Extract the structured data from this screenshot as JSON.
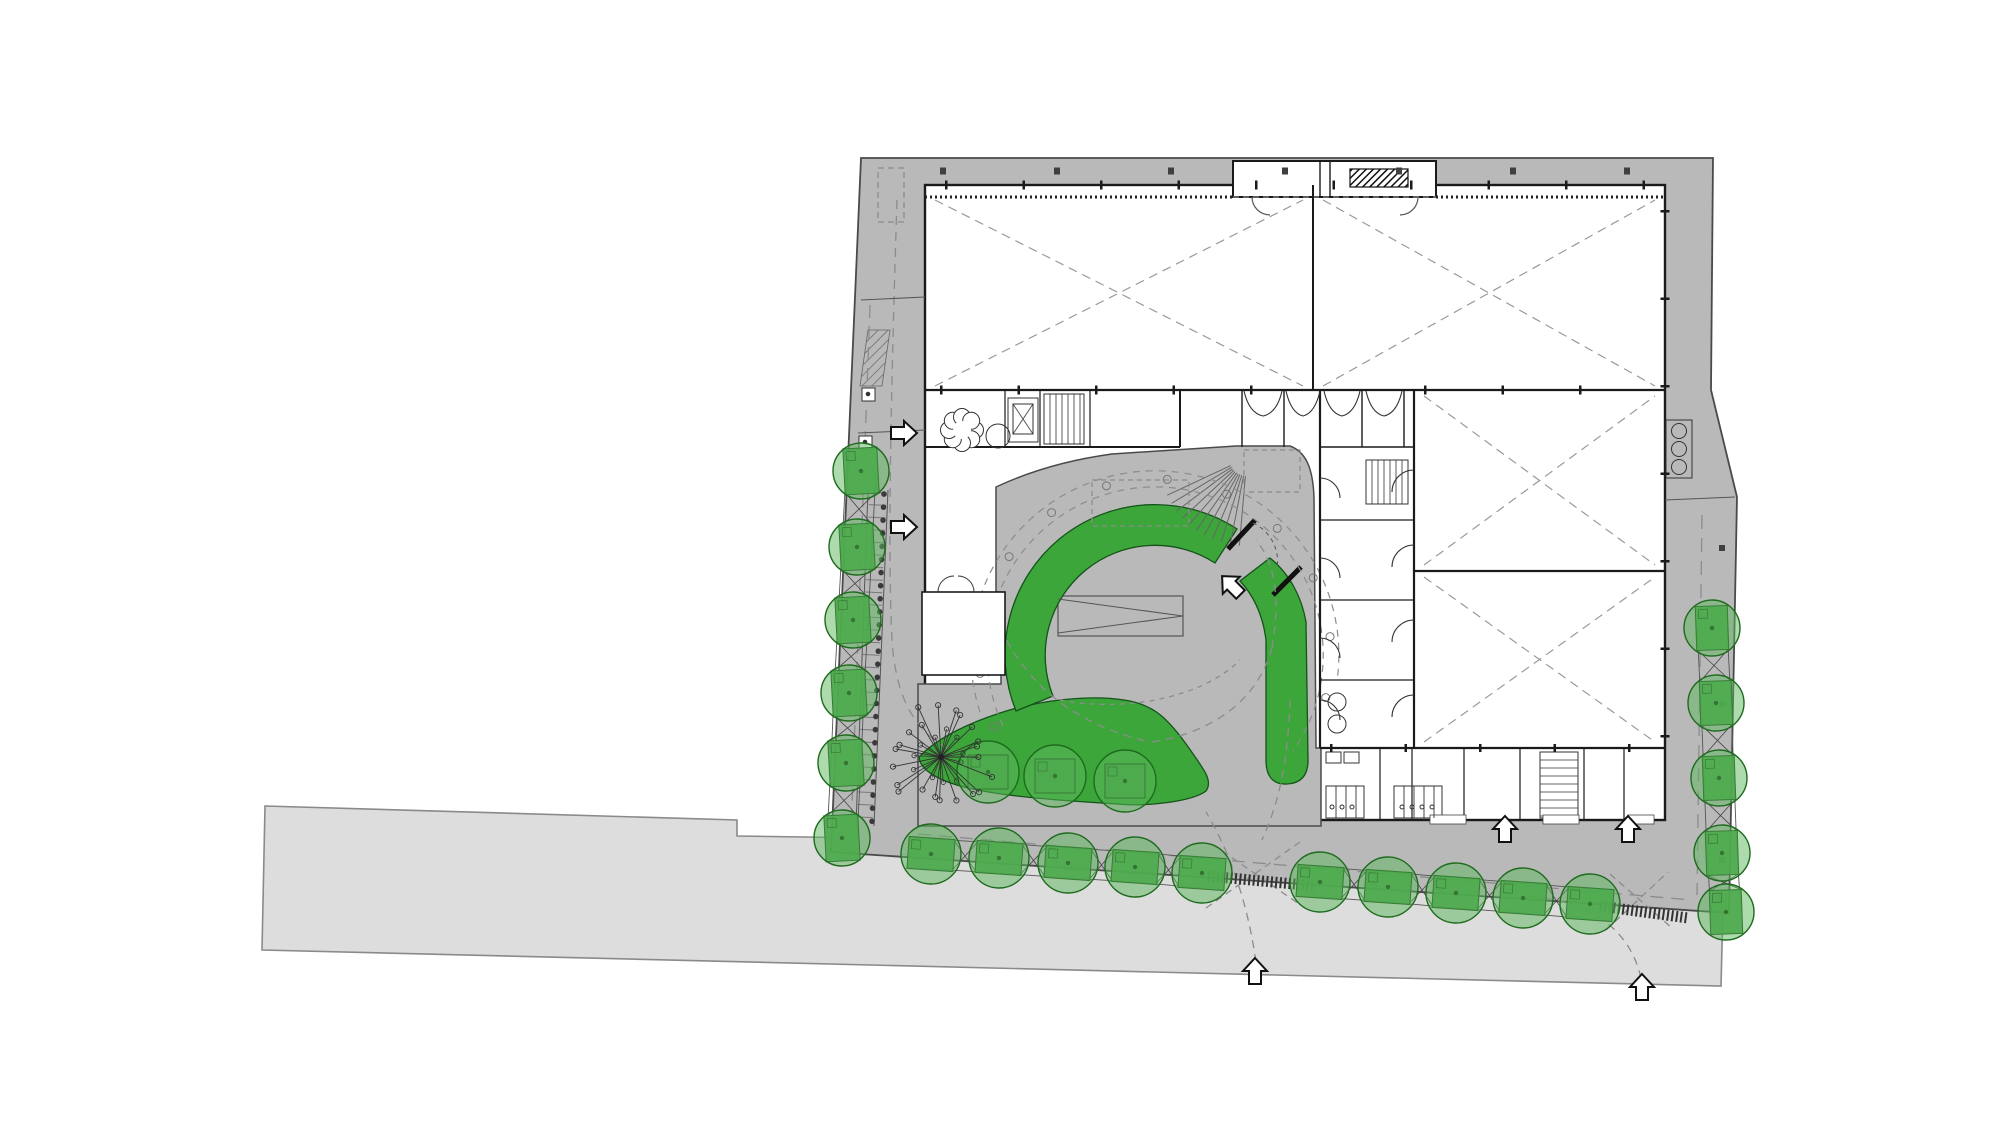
{
  "drawing": {
    "kind": "architectural-site-plan",
    "canvas": {
      "w": 2000,
      "h": 1143
    },
    "palette": {
      "paper": "#ffffff",
      "street_fill": "#dddddd",
      "street_stroke": "#8a8a8a",
      "sidewalk_fill": "#b9b9b9",
      "sidewalk_stroke": "#4a4a4a",
      "building_fill": "#ffffff",
      "wall": "#1a1a1a",
      "detail": "#555555",
      "dash": "#8c8c8c",
      "green_main": "#3ca63a",
      "green_main_stroke": "#15531a",
      "tree_fill": "#5cb85c",
      "tree_stroke": "#1d6b1d",
      "planter_fill": "#3f9d3f",
      "planter_stroke": "#163f16",
      "branch": "#333333"
    },
    "street": {
      "points": [
        [
          265,
          806
        ],
        [
          737,
          820
        ],
        [
          737,
          836
        ],
        [
          1694,
          850
        ],
        [
          1725,
          830
        ],
        [
          1721,
          986
        ],
        [
          262,
          950
        ]
      ]
    },
    "site": {
      "points": [
        [
          861,
          158
        ],
        [
          1713,
          158
        ],
        [
          1711,
          390
        ],
        [
          1737,
          497
        ],
        [
          1729,
          913
        ],
        [
          831,
          852
        ]
      ]
    },
    "building": {
      "x": 925,
      "y": 185,
      "w": 740,
      "h": 635
    },
    "plaza_path": "M918,826 L918,684 L1001,684 L1001,592 L996,592 L996,487 C1028,472 1068,460 1112,454 L1236,446 L1290,446 C1306,452 1313,468 1314,498 L1316,748 L1321,748 L1321,826 Z",
    "niche": {
      "rect": [
        1233,
        161,
        203,
        36
      ],
      "hatch_bar": [
        1350,
        169,
        58,
        18
      ],
      "walls": [
        [
          1320,
          162,
          1320,
          196
        ],
        [
          1330,
          162,
          1330,
          196
        ]
      ],
      "arcs": [
        "M1252,197 A18,18 0 0 0 1270,215",
        "M1418,197 A18,18 0 0 1 1400,215"
      ]
    },
    "room_block": {
      "rect": [
        922,
        592,
        83,
        83
      ],
      "arcs": [
        "M938,592 A16,16 0 0 1 954,576",
        "M974,592 A16,16 0 0 0 958,576"
      ]
    },
    "halls_x": [
      [
        935,
        200,
        1303,
        386
      ],
      [
        1323,
        200,
        1655,
        386
      ],
      [
        1424,
        396,
        1655,
        565
      ],
      [
        1424,
        577,
        1655,
        742
      ]
    ],
    "walls": [
      [
        925,
        390,
        1665,
        390,
        2.2
      ],
      [
        1313,
        185,
        1313,
        390,
        2.0
      ],
      [
        925,
        447,
        1180,
        447,
        2.0
      ],
      [
        1180,
        390,
        1180,
        447,
        2.0
      ],
      [
        1320,
        390,
        1320,
        748,
        2.2
      ],
      [
        1414,
        390,
        1414,
        748,
        2.2
      ],
      [
        1414,
        571,
        1665,
        571,
        2.2
      ],
      [
        1320,
        748,
        1665,
        748,
        2.2
      ],
      [
        1320,
        447,
        1414,
        447,
        1.5
      ],
      [
        1242,
        390,
        1242,
        447,
        1.4
      ],
      [
        1284,
        390,
        1284,
        447,
        1.4
      ],
      [
        1362,
        390,
        1362,
        447,
        1.4
      ],
      [
        1404,
        390,
        1404,
        447,
        1.4
      ],
      [
        1380,
        748,
        1380,
        820,
        1.2
      ],
      [
        1412,
        748,
        1412,
        820,
        1.2
      ],
      [
        1464,
        748,
        1464,
        820,
        1.2
      ],
      [
        1520,
        748,
        1520,
        820,
        1.2
      ],
      [
        1584,
        748,
        1584,
        820,
        1.2
      ],
      [
        1624,
        748,
        1624,
        820,
        1.2
      ],
      [
        1320,
        520,
        1414,
        520,
        1.2
      ],
      [
        1320,
        600,
        1414,
        600,
        1.2
      ],
      [
        1320,
        680,
        1414,
        680,
        1.2
      ],
      [
        1005,
        390,
        1005,
        447,
        1.2
      ],
      [
        1040,
        390,
        1040,
        447,
        1.2
      ],
      [
        1090,
        390,
        1090,
        447,
        1.2
      ],
      [
        963,
        592,
        963,
        675,
        1.1
      ]
    ],
    "thin_lines": [
      [
        888,
        490,
        874,
        826
      ],
      [
        868,
        490,
        856,
        826
      ],
      [
        861,
        300,
        925,
        297
      ],
      [
        858,
        433,
        925,
        430
      ],
      [
        1665,
        500,
        1735,
        497
      ],
      [
        1013,
        404,
        1033,
        434
      ],
      [
        1013,
        434,
        1033,
        404
      ],
      [
        1058,
        599,
        1183,
        616
      ],
      [
        1058,
        633,
        1183,
        616
      ]
    ],
    "bench": {
      "rect": [
        1058,
        596,
        125,
        40
      ]
    },
    "stairs": [
      {
        "x": 1044,
        "y": 394,
        "w": 40,
        "h": 50,
        "dir": "v",
        "step": 6
      },
      {
        "x": 1366,
        "y": 460,
        "w": 42,
        "h": 44,
        "dir": "v",
        "step": 6
      },
      {
        "x": 1540,
        "y": 752,
        "w": 38,
        "h": 66,
        "dir": "h",
        "step": 8
      }
    ],
    "fan_stair": {
      "cx": 1247,
      "cy": 458,
      "a1": 95,
      "a2": 155,
      "r1": 18,
      "r2": 88,
      "n": 11
    },
    "flower": {
      "cx": 962,
      "cy": 430,
      "petal_r": 8.5,
      "ring_r": 13,
      "petals": 8,
      "side_circle": [
        998,
        436,
        12
      ]
    },
    "rects": [
      {
        "x": 1008,
        "y": 398,
        "w": 30,
        "h": 44,
        "f": "none"
      },
      {
        "x": 1013,
        "y": 404,
        "w": 20,
        "h": 30,
        "f": "none"
      },
      {
        "x": 1666,
        "y": 420,
        "w": 26,
        "h": 58,
        "f": "none"
      },
      {
        "x": 862,
        "y": 388,
        "w": 13,
        "h": 13,
        "f": "#fff"
      },
      {
        "x": 859,
        "y": 436,
        "w": 13,
        "h": 13,
        "f": "#fff"
      },
      {
        "x": 1326,
        "y": 752,
        "w": 15,
        "h": 11,
        "f": "none"
      },
      {
        "x": 1344,
        "y": 752,
        "w": 15,
        "h": 11,
        "f": "none"
      },
      {
        "x": 1326,
        "y": 786,
        "w": 38,
        "h": 32,
        "f": "none"
      },
      {
        "x": 1394,
        "y": 786,
        "w": 48,
        "h": 32,
        "f": "none"
      }
    ],
    "white_openings": [
      [
        1430,
        815,
        36,
        9
      ],
      [
        1543,
        815,
        36,
        9
      ],
      [
        1628,
        815,
        26,
        9
      ]
    ],
    "stall_lines": [
      [
        1336,
        786,
        1336,
        818
      ],
      [
        1346,
        786,
        1346,
        818
      ],
      [
        1356,
        786,
        1356,
        818
      ],
      [
        1404,
        786,
        1404,
        818
      ],
      [
        1414,
        786,
        1414,
        818
      ],
      [
        1424,
        786,
        1424,
        818
      ],
      [
        1434,
        786,
        1434,
        818
      ]
    ],
    "circles": [
      {
        "cx": 1679,
        "cy": 431,
        "r": 7.5
      },
      {
        "cx": 1679,
        "cy": 449,
        "r": 7.5
      },
      {
        "cx": 1679,
        "cy": 467,
        "r": 7.5
      },
      {
        "cx": 1337,
        "cy": 702,
        "r": 9
      },
      {
        "cx": 1337,
        "cy": 724,
        "r": 9
      },
      {
        "cx": 868,
        "cy": 394,
        "r": 1.8,
        "fill": "#333"
      },
      {
        "cx": 865,
        "cy": 442,
        "r": 1.8,
        "fill": "#333"
      },
      {
        "cx": 1332,
        "cy": 807,
        "r": 2
      },
      {
        "cx": 1342,
        "cy": 807,
        "r": 2
      },
      {
        "cx": 1352,
        "cy": 807,
        "r": 2
      },
      {
        "cx": 1402,
        "cy": 807,
        "r": 2
      },
      {
        "cx": 1412,
        "cy": 807,
        "r": 2
      },
      {
        "cx": 1422,
        "cy": 807,
        "r": 2
      },
      {
        "cx": 1432,
        "cy": 807,
        "r": 2
      }
    ],
    "doors": [
      "M1320,478 A20,20 0 0 1 1340,498",
      "M1320,558 A20,20 0 0 1 1340,578",
      "M1320,638 A20,20 0 0 1 1340,658",
      "M1320,700 A20,20 0 0 1 1340,720",
      "M1414,470 A22,22 0 0 0 1392,492",
      "M1414,545 A22,22 0 0 0 1392,567",
      "M1414,620 A22,22 0 0 0 1392,642",
      "M1414,695 A22,22 0 0 0 1392,717",
      "M1244,391 Q1249,413 1263,416 Q1277,413 1282,391",
      "M1286,391 Q1291,413 1303,416 Q1315,413 1320,391",
      "M1324,391 Q1329,413 1342,416 Q1355,413 1360,391",
      "M1366,391 Q1371,413 1384,416 Q1397,413 1402,391"
    ],
    "crescent": {
      "a": "M1016,711 A150,150 0 0 1 1237,529 L1215,563 A110,110 0 0 0 1053,696 Z",
      "b": "M1270,558 C1290,574 1302,598 1306,622 L1308,758 Q1309,783 1287,784 Q1266,785 1266,760 L1266,640 C1263,616 1254,596 1240,581 Z"
    },
    "amoeba_path": "M919,757 C938,737 972,722 1000,713 C1042,699 1093,695 1124,700 C1152,704 1167,716 1191,751 C1205,771 1213,781 1206,791 C1193,801 1149,807 1117,804 C1068,801 1008,797 973,789 C944,783 920,772 919,757 Z",
    "rings": {
      "cx": 1155,
      "cy": 655,
      "r1": 168,
      "r2": 184,
      "dot_r": 176,
      "dot_angles": [
        204,
        186,
        166,
        146,
        126,
        106,
        86,
        66,
        46,
        26,
        6,
        -14
      ],
      "arc1": "M1003,726 A168,168 0 1 1 1293,751",
      "arc2": "M980,712 A184,184 0 1 1 1337,681"
    },
    "gates": {
      "bars": [
        [
          1228,
          549,
          1255,
          520
        ],
        [
          1273,
          595,
          1301,
          567
        ]
      ],
      "swing": "M1253,523 A42,42 0 0 1 1277,568"
    },
    "dash_paths": [
      {
        "d": "M918,834 L1692,900",
        "dash": "13 8"
      },
      {
        "d": "M870,305 L851,832",
        "dash": "13 8"
      },
      {
        "d": "M897,200 C890,420 888,560 892,640 C896,700 915,733 955,752",
        "dash": "9 7"
      },
      {
        "d": "M1256,962 C1248,906 1232,856 1206,812",
        "dash": "8 6"
      },
      {
        "d": "M1641,978 C1630,930 1592,902 1530,896",
        "dash": "8 6"
      },
      {
        "d": "M1206,908 L1300,842",
        "dash": "7 5"
      },
      {
        "d": "M1212,844 L1302,906",
        "dash": "7 5"
      },
      {
        "d": "M1606,930 L1668,872",
        "dash": "7 5"
      },
      {
        "d": "M1610,874 L1672,928",
        "dash": "7 5"
      },
      {
        "d": "M1000,628 C1030,690 1080,726 1150,742",
        "dash": "8 6"
      },
      {
        "d": "M1152,742 C1216,732 1258,698 1272,648",
        "dash": "8 6"
      },
      {
        "d": "M1272,648 C1280,600 1276,564 1256,540",
        "dash": "8 6"
      },
      {
        "d": "M1060,700 C1120,712 1200,700 1240,660",
        "dash": "5 5"
      },
      {
        "d": "M1290,700 C1288,760 1280,800 1262,840",
        "dash": "8 6"
      },
      {
        "d": "M1092,480 H1189 V526 H1092 Z",
        "dash": "5 4"
      },
      {
        "d": "M878,168 H904 V222 H878 Z",
        "dash": "6 4"
      },
      {
        "d": "M1244,450 H1300 V492 H1244 Z",
        "dash": "5 4"
      },
      {
        "d": "M1702,515 L1697,895",
        "dash": "14 9"
      },
      {
        "d": "M1233,197 H1436",
        "dash": "6 4"
      }
    ],
    "tick_lines": [
      [
        940,
        171,
        1660,
        171,
        "6 108",
        7,
        "#3f3f3f",
        ""
      ],
      [
        945,
        185,
        1655,
        185,
        "2.5 75",
        9,
        "#1a1a1a",
        ""
      ],
      [
        940,
        390,
        1310,
        390,
        "2.5 75",
        9,
        "#1a1a1a",
        ""
      ],
      [
        1424,
        390,
        1655,
        390,
        "2.5 75",
        9,
        "#1a1a1a",
        ""
      ],
      [
        1330,
        748,
        1655,
        748,
        "2.5 72",
        8,
        "#1a1a1a",
        ""
      ],
      [
        1665,
        210,
        1665,
        812,
        "2.5 85",
        9,
        "#1a1a1a",
        ""
      ],
      [
        925,
        197,
        1233,
        197,
        "2 3",
        3,
        "#222222",
        ""
      ],
      [
        1436,
        197,
        1665,
        197,
        "2 3",
        3,
        "#222222",
        ""
      ],
      [
        1722,
        545,
        1722,
        885,
        "6 150",
        6,
        "#3f3f3f",
        ""
      ],
      [
        878,
        492,
        864,
        824,
        "1 11.5",
        17,
        "#777777",
        ""
      ],
      [
        884,
        494,
        872,
        822,
        "0.1 13",
        5.5,
        "#3a3a3a",
        "round"
      ],
      [
        1208,
        876,
        1316,
        886,
        "2 2.5",
        11,
        "#333333",
        ""
      ],
      [
        1600,
        906,
        1688,
        918,
        "2 2.5",
        11,
        "#333333",
        ""
      ]
    ],
    "tree_rows": [
      {
        "name": "left-sidewalk-trees",
        "r": 28,
        "planter": [
          34,
          46
        ],
        "rot": -3,
        "trench": true,
        "pts": [
          [
            861,
            471
          ],
          [
            857,
            547
          ],
          [
            853,
            620
          ],
          [
            849,
            693
          ],
          [
            846,
            763
          ],
          [
            842,
            838
          ]
        ]
      },
      {
        "name": "bottom-sidewalk-trees",
        "r": 30,
        "planter": [
          46,
          32
        ],
        "rot": 4,
        "trench": true,
        "pts": [
          [
            931,
            854
          ],
          [
            999,
            858
          ],
          [
            1068,
            863
          ],
          [
            1135,
            867
          ],
          [
            1202,
            873
          ],
          [
            1320,
            882
          ],
          [
            1388,
            887
          ],
          [
            1456,
            893
          ],
          [
            1523,
            898
          ],
          [
            1590,
            904
          ]
        ]
      },
      {
        "name": "right-sidewalk-trees",
        "r": 28,
        "planter": [
          32,
          44
        ],
        "rot": -2,
        "trench": true,
        "pts": [
          [
            1712,
            628
          ],
          [
            1716,
            703
          ],
          [
            1719,
            778
          ],
          [
            1722,
            853
          ],
          [
            1726,
            912
          ]
        ]
      },
      {
        "name": "courtyard-lawn-trees",
        "r": 31,
        "planter": [
          40,
          34
        ],
        "rot": 0,
        "trench": false,
        "pts": [
          [
            988,
            772
          ],
          [
            1055,
            776
          ],
          [
            1125,
            781
          ]
        ]
      }
    ],
    "special_tree": {
      "cx": 941,
      "cy": 757,
      "r": 52,
      "branches": 22
    },
    "arrows": [
      {
        "x": 903,
        "y": 433,
        "rot": 90
      },
      {
        "x": 903,
        "y": 527,
        "rot": 90
      },
      {
        "x": 1232,
        "y": 586,
        "rot": -45
      },
      {
        "x": 1505,
        "y": 830,
        "rot": 0
      },
      {
        "x": 1628,
        "y": 830,
        "rot": 0
      },
      {
        "x": 1255,
        "y": 972,
        "rot": 0
      },
      {
        "x": 1642,
        "y": 988,
        "rot": 0
      }
    ],
    "arrow_path": "M0,-14 L12,-1 L6,-1 L6,12 L-6,12 L-6,-1 L-12,-1 Z"
  }
}
